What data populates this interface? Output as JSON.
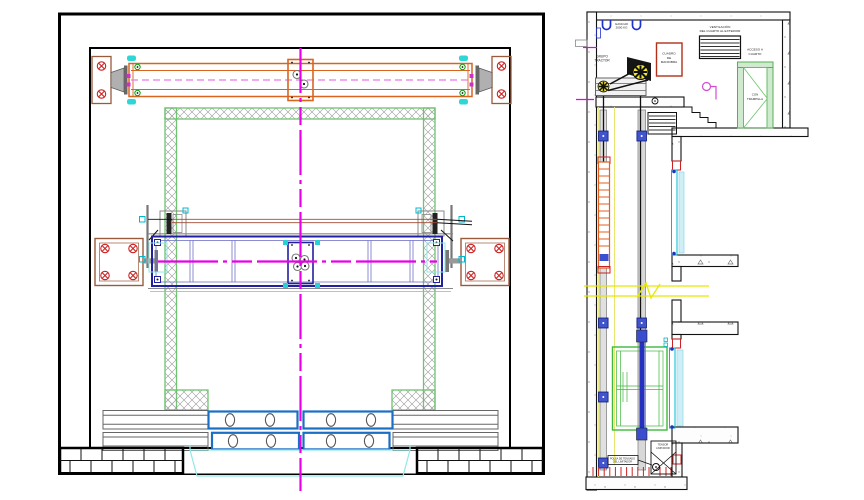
{
  "colors": {
    "centerline_magenta": "#e800e8",
    "beam_orange": "#d96420",
    "bedplate_blue": "#2020a0",
    "frame_green": "#6fc46f",
    "cabin_green": "#3db83d",
    "door_cyan": "#00b8cc",
    "anchor_brown": "#9a5a3c",
    "bolt_red": "#cc2222",
    "break_yellow": "#e8e800",
    "bracket_blue": "#3a4fd0",
    "counterweight_orange": "#e06020",
    "sheave_yellow": "#f5e62e"
  },
  "section": {
    "labels": {
      "hook": {
        "line1": "GANCHO",
        "line2": "2000 KG"
      },
      "grupo": {
        "line1": "GRUPO",
        "line2": "TRACTOR"
      },
      "cuadro": {
        "line1": "CUADRO",
        "line2": "DE",
        "line3": "MANIOBRA"
      },
      "vent": {
        "line1": "VENTILACIÓN",
        "line2": "DEL CUARTO AL EXTERIOR"
      },
      "acceso": {
        "line1": "ACCESO A",
        "line2": "CUARTO"
      },
      "puerta": {
        "line1": "CON",
        "line2": "TRAMPILLA"
      },
      "polea": {
        "line1": "POLEA DE TENSADO",
        "line2": "DEL LIMITADOR"
      },
      "tensor": {
        "line1": "TENSOR",
        "line2": "LIMITADOR"
      }
    }
  }
}
